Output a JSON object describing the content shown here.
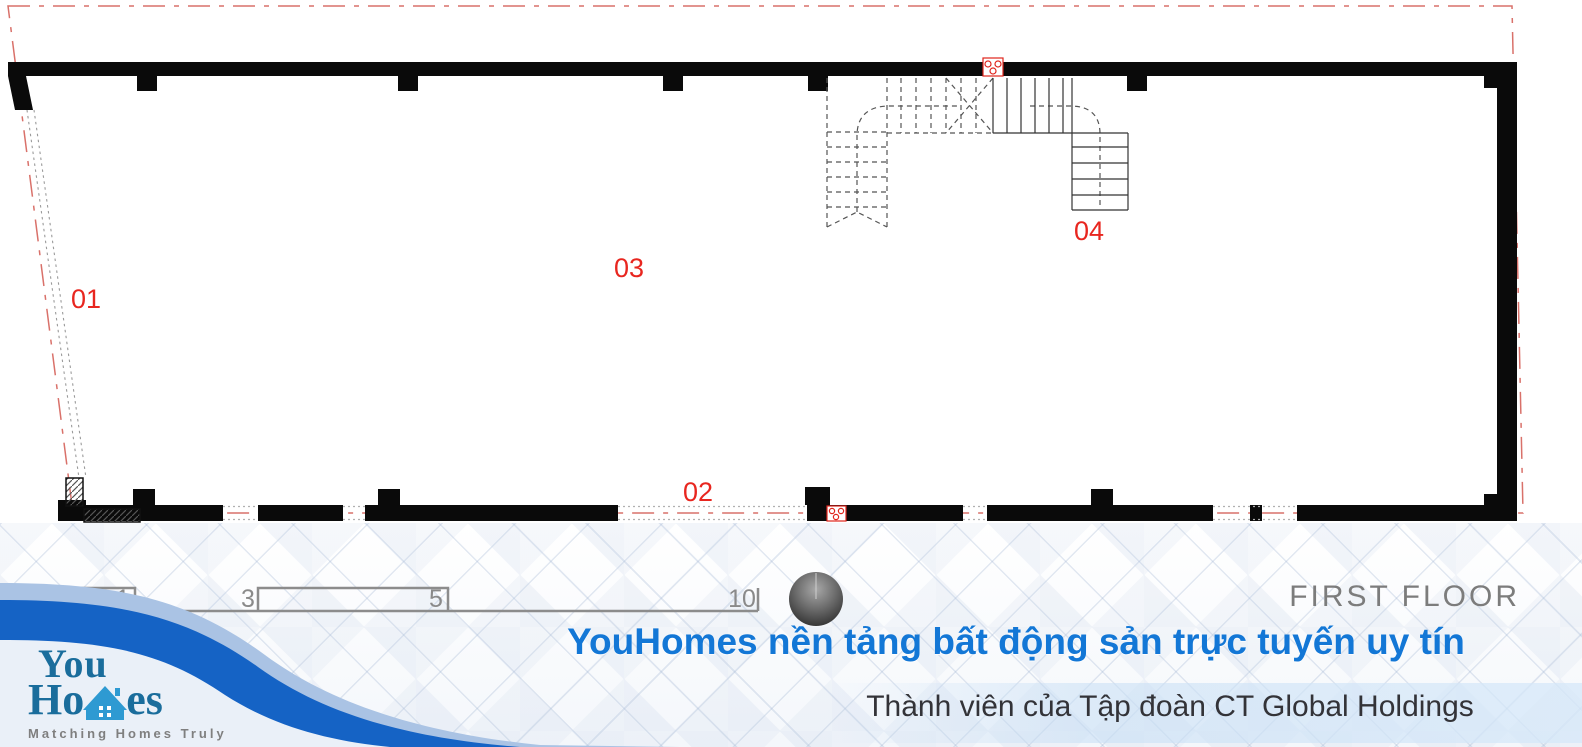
{
  "plan": {
    "floor_label": "FIRST FLOOR",
    "rooms": [
      {
        "label": "01"
      },
      {
        "label": "02"
      },
      {
        "label": "03"
      },
      {
        "label": "04"
      }
    ],
    "scale_ticks": [
      "0",
      "1",
      "3",
      "5",
      "10"
    ],
    "icons": {
      "compass": "north-indicator-sphere",
      "wall_fixture": "red-circles-fixture-symbol",
      "stair": "u-shaped-staircase"
    },
    "colors": {
      "wall": "#0a0a0a",
      "boundary_line": "#d9716a",
      "room_label": "#e8261f",
      "scale_gray": "#8a8a8a"
    }
  },
  "branding": {
    "logo": {
      "line1": "You",
      "line2_prefix": "Ho",
      "line2_suffix": "es",
      "tagline": "Matching Homes Truly",
      "house_icon": "house-icon"
    },
    "slogan": "YouHomes nền tảng bất động sản trực tuyến uy tín",
    "membership": "Thành viên của Tập đoàn CT Global Holdings",
    "colors": {
      "slogan_blue": "#1377d6",
      "logo_blue": "#1a6d9c",
      "house_blue": "#2e9ad2",
      "wave_dark": "#1563c5",
      "wave_light": "#aac3e4",
      "membership_text": "#333338"
    }
  }
}
